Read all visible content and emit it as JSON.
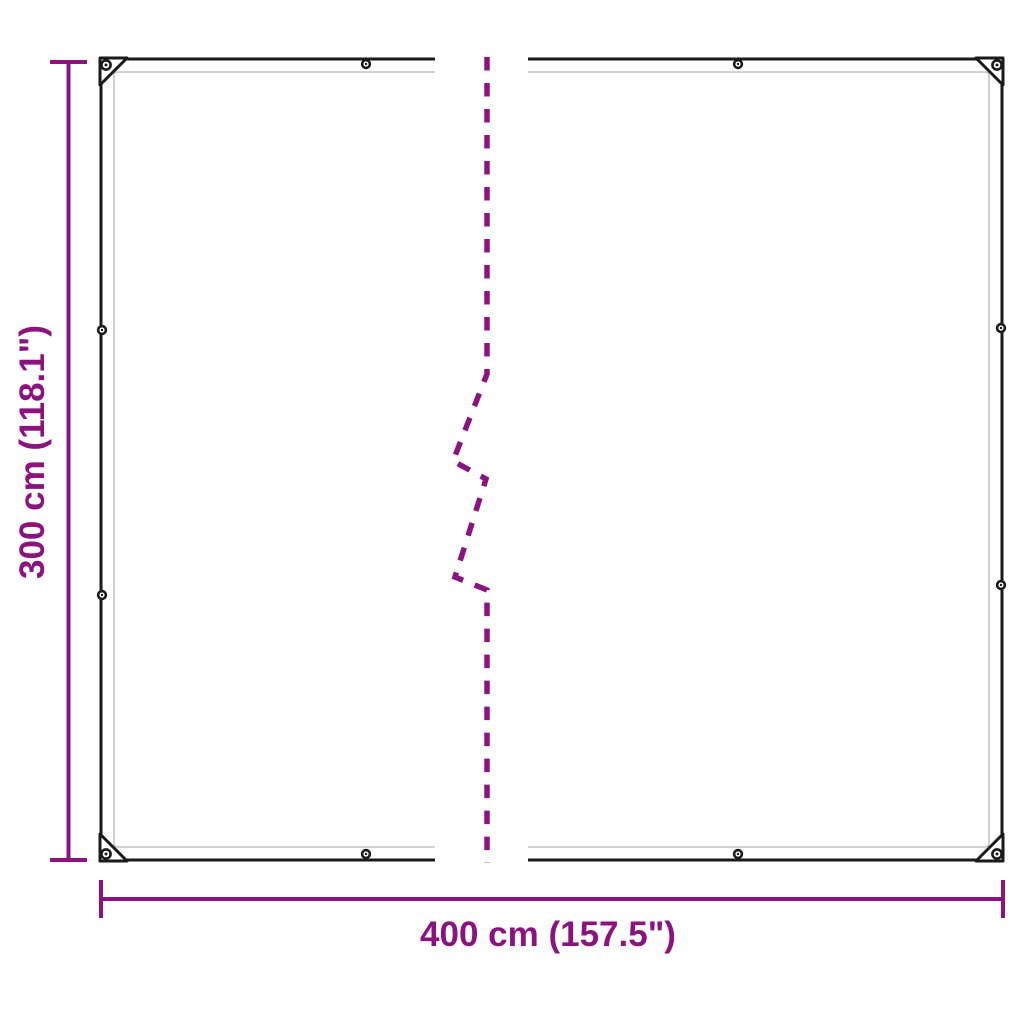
{
  "diagram": {
    "kind": "product-dimension-diagram",
    "height_label": "300 cm (118.1\")",
    "width_label": "400 cm (157.5\")"
  },
  "colors": {
    "dimension": "#8b1380",
    "outline": "#1a1a1a",
    "seam": "#c4c4c4",
    "background": "#ffffff"
  }
}
